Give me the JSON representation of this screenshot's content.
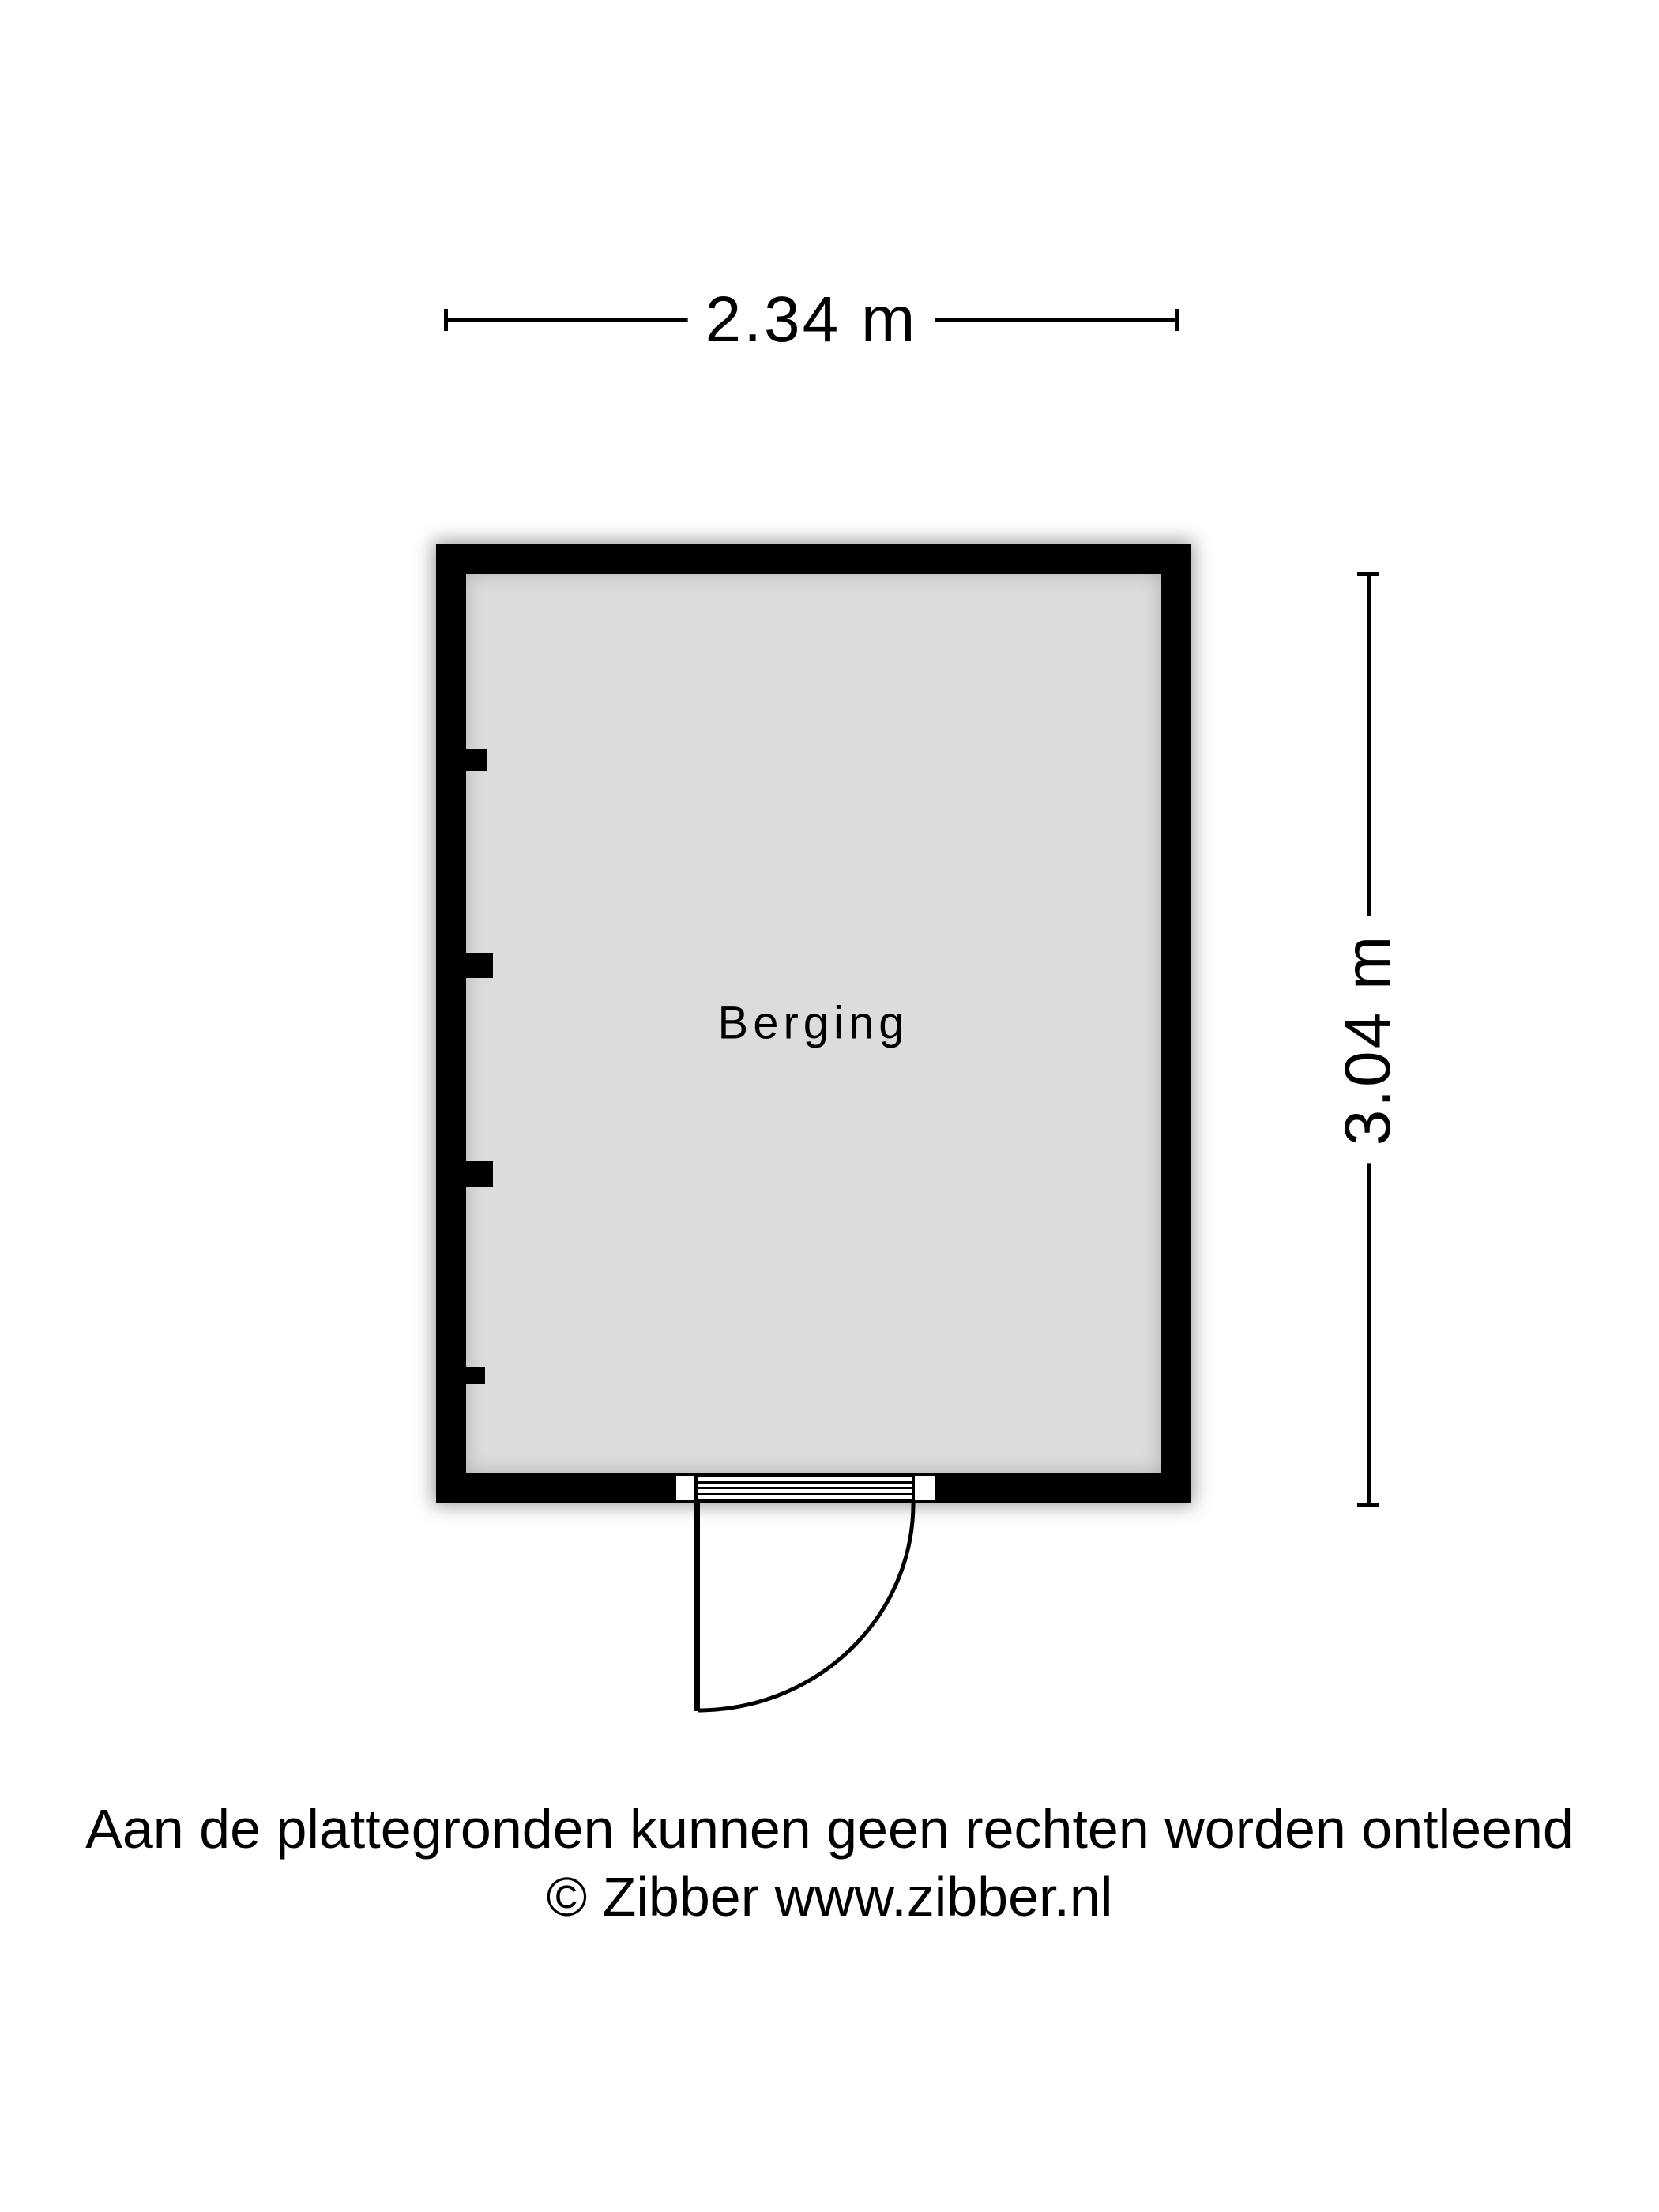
{
  "floorplan": {
    "room": {
      "label": "Berging",
      "floor_color": "#dcdcdc",
      "wall_color": "#000000"
    },
    "dimensions": {
      "width_label": "2.34 m",
      "height_label": "3.04 m"
    }
  },
  "footer": {
    "disclaimer": "Aan de plattegronden kunnen geen rechten worden ontleend",
    "copyright": "© Zibber www.zibber.nl"
  }
}
